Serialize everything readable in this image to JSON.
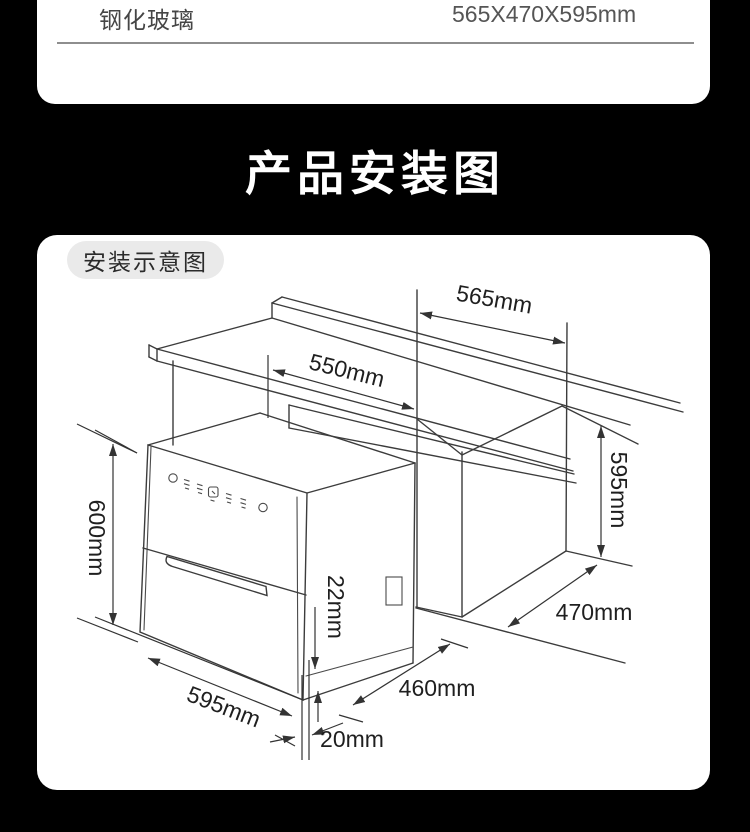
{
  "spec_row": {
    "material": "钢化玻璃",
    "size": "565X470X595mm"
  },
  "banner": {
    "title": "产品安装图"
  },
  "diagram": {
    "badge": "安装示意图",
    "dims": {
      "counter_width": "565mm",
      "opening_width": "550mm",
      "niche_height": "595mm",
      "appliance_height": "600mm",
      "door_overhang": "22mm",
      "niche_depth": "470mm",
      "appliance_depth": "460mm",
      "appliance_width": "595mm",
      "side_gap": "20mm"
    }
  },
  "colors": {
    "background": "#000000",
    "card": "#ffffff",
    "line": "#3c3c3c",
    "badge_bg": "#eaeaea"
  }
}
